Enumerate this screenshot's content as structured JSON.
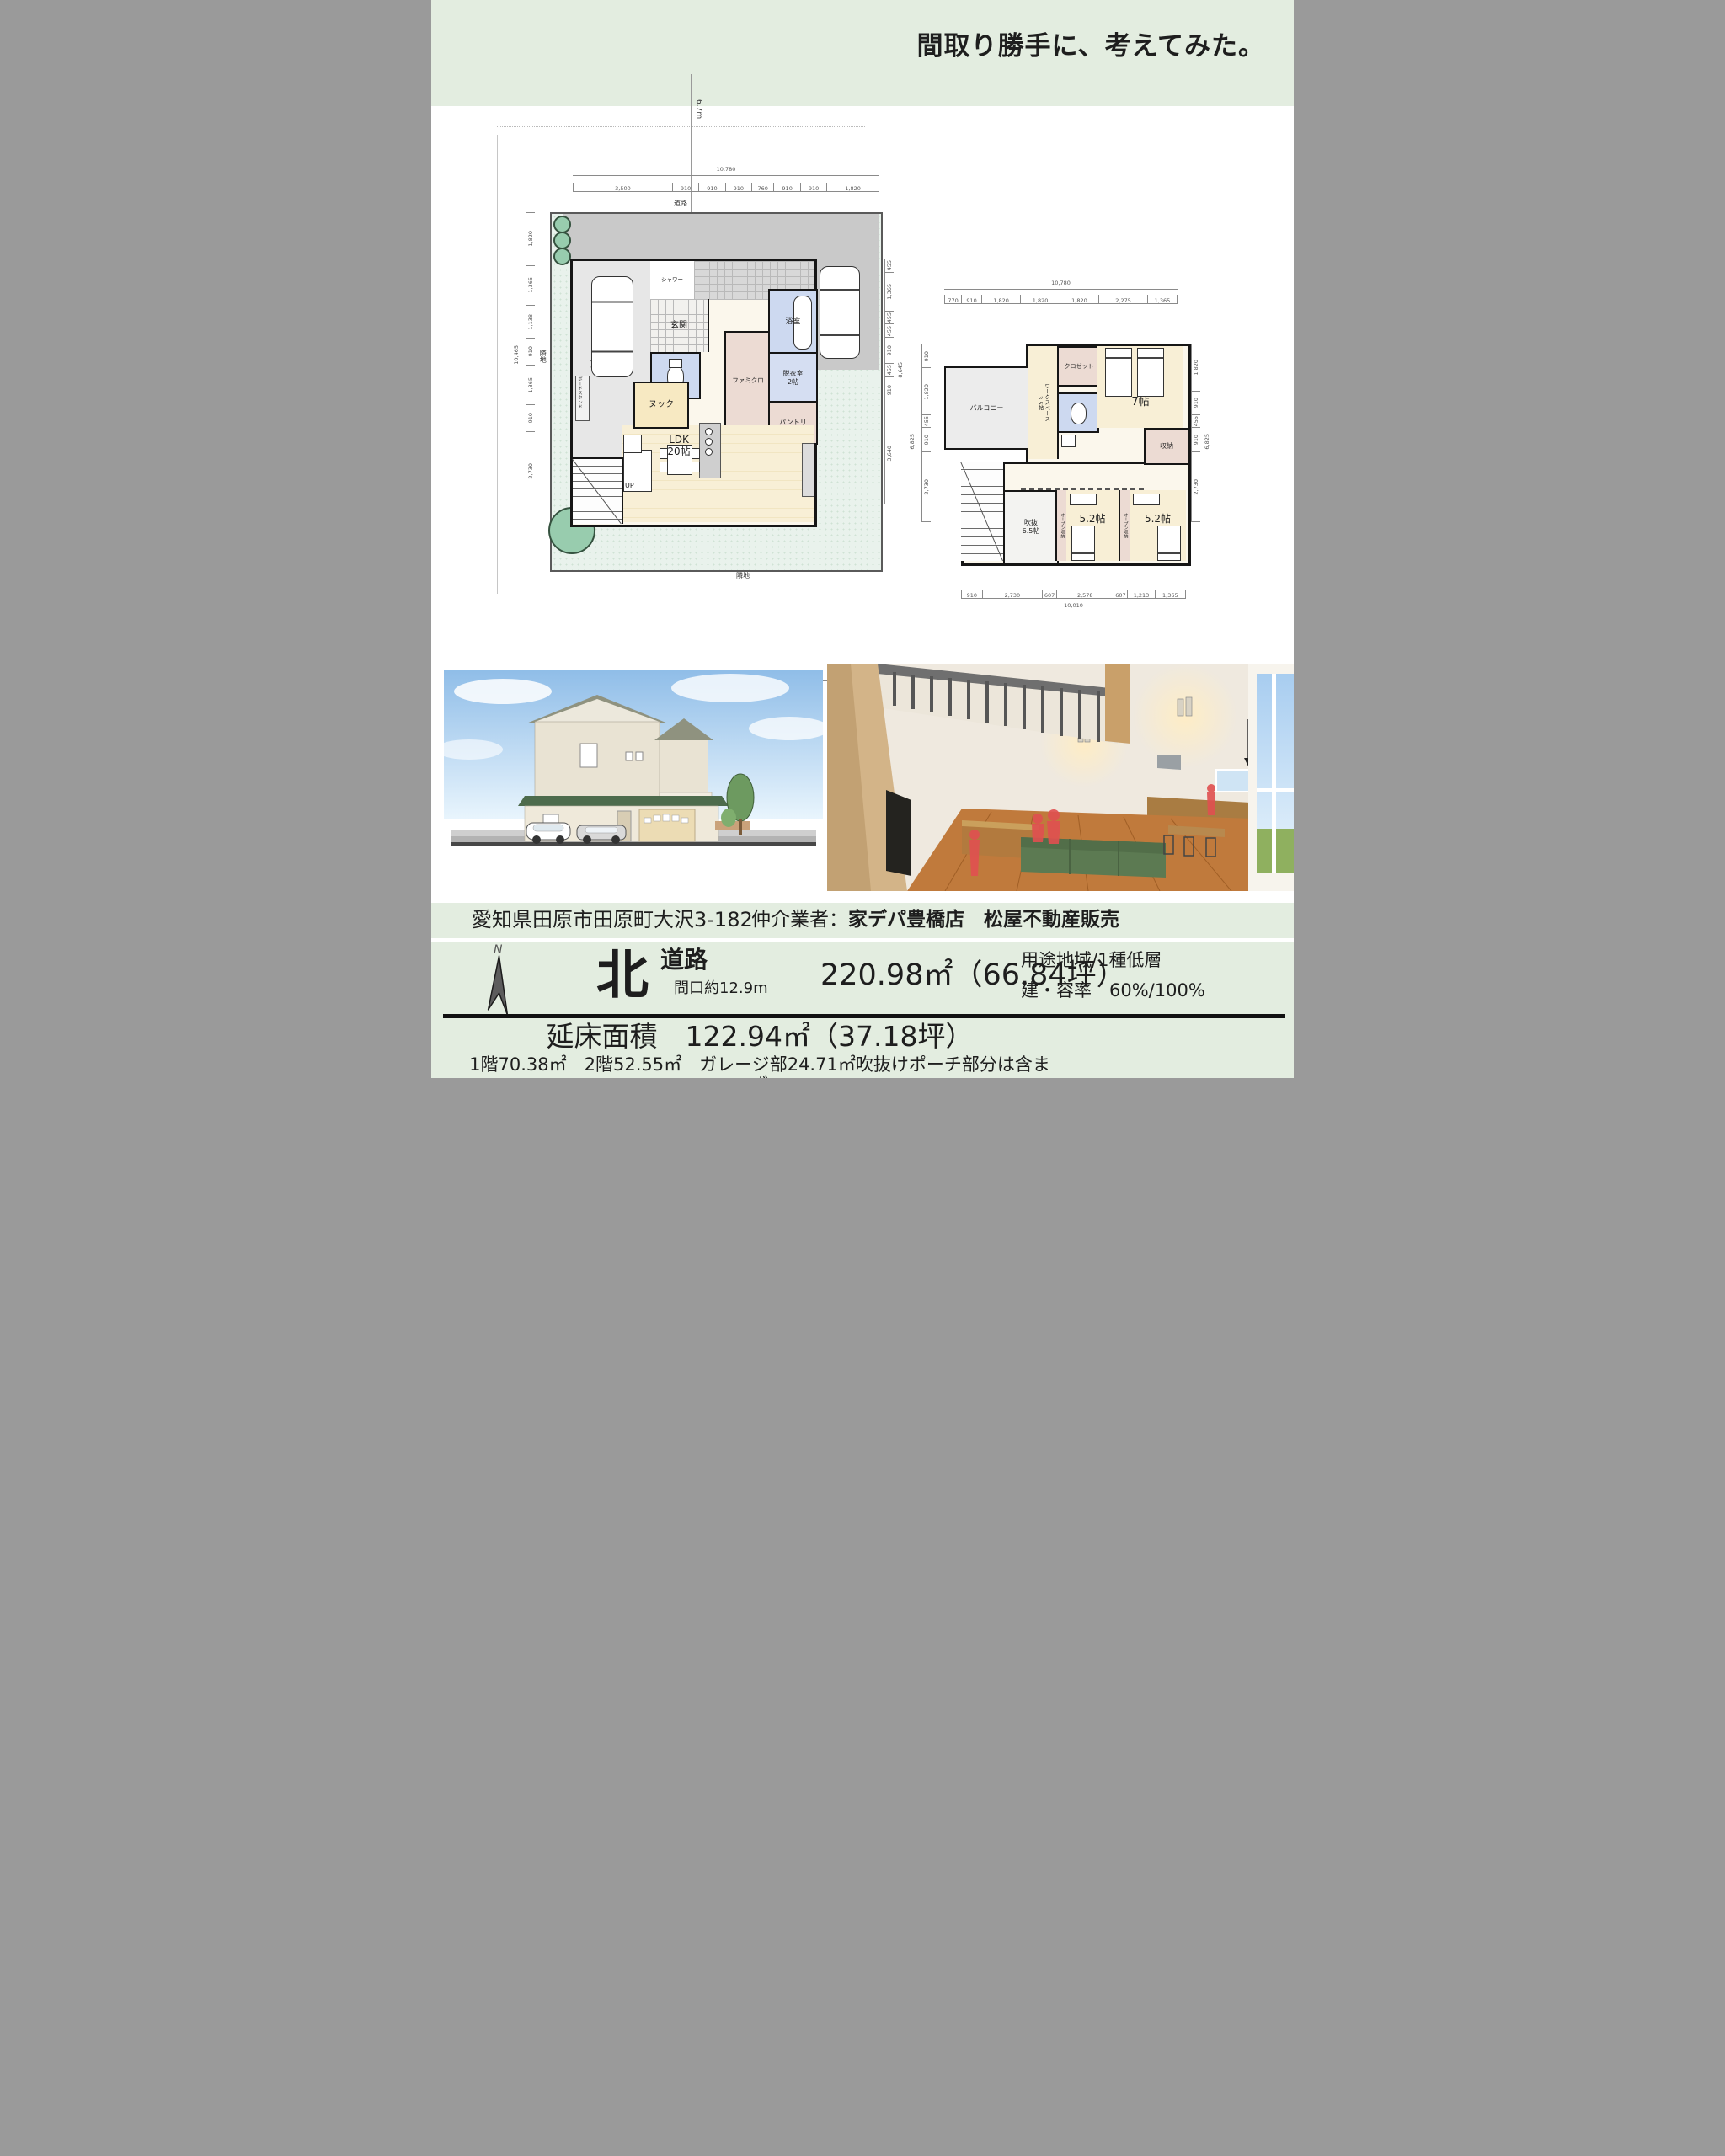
{
  "header": {
    "title": "間取り勝手に、考えてみた。"
  },
  "colors": {
    "band_green": "#e3ede0",
    "site_green": "#e9f2ec",
    "driveway_gray": "#c9c9c9",
    "room_cream": "#f8efd6",
    "wet_blue": "#cdd9f0",
    "closet_pink": "#ecdbd3",
    "wall_black": "#161616",
    "roof_green": "#4d6b4c",
    "tree_green": "#98ccae",
    "sofa_green": "#5c7a52",
    "silhouette_red": "#e05050"
  },
  "plan1": {
    "road": {
      "width_label": "6.7m",
      "road_label": "道路"
    },
    "site_labels": {
      "left": "隣地",
      "right": "隣地",
      "bottom": "隣地"
    },
    "rooms": {
      "garage": "ガレージ",
      "board_stand": "ボードスタンド",
      "shower": "シャワー",
      "entrance": "玄関",
      "famiclo": "ファミクロ",
      "bath": "浴室",
      "dressing": "脱衣室",
      "dressing_size": "2帖",
      "nook": "ヌック",
      "pantry": "パントリ",
      "ldk": "LDK",
      "ldk_size": "20帖",
      "up": "UP"
    },
    "dims": {
      "top": {
        "total": "10,780",
        "values": [
          3500,
          910,
          910,
          910,
          760,
          910,
          910,
          1820
        ],
        "labels": [
          "3,500",
          "910",
          "910",
          "910",
          "760",
          "910",
          "910",
          "1,820"
        ]
      },
      "bottom": {
        "total": "10,780",
        "values": [
          770,
          910,
          1820,
          910,
          1820,
          1670,
          455,
          2275
        ],
        "labels": [
          "770",
          "910",
          "1,820",
          "910",
          "1,820",
          "1,670",
          "455",
          "2,275"
        ]
      },
      "left": {
        "total": "10,465",
        "values": [
          1820,
          1365,
          1138,
          910,
          1365,
          910,
          2730
        ],
        "labels": [
          "1,820",
          "1,365",
          "1,138",
          "910",
          "1,365",
          "910",
          "2,730"
        ]
      },
      "right": {
        "total": "8,645",
        "values": [
          455,
          1365,
          455,
          455,
          910,
          455,
          910,
          3640
        ],
        "labels": [
          "455",
          "1,365",
          "455",
          "455",
          "910",
          "455",
          "910",
          "3,640"
        ]
      }
    }
  },
  "plan2": {
    "rooms": {
      "balcony": "バルコニー",
      "workspace": "ワークスペース\n3.5帖",
      "closet": "クロゼット",
      "bed7": "7帖",
      "dn": "DN",
      "storage": "収納",
      "void": "吹抜\n6.5帖",
      "open_storage": "オープン収納",
      "bed52": "5.2帖"
    },
    "dims": {
      "top": {
        "total": "10,780",
        "values": [
          770,
          910,
          1820,
          1820,
          1820,
          2275,
          1365
        ],
        "labels": [
          "770",
          "910",
          "1,820",
          "1,820",
          "1,820",
          "2,275",
          "1,365"
        ]
      },
      "bottom": {
        "total": "10,010",
        "values": [
          910,
          2730,
          607,
          2578,
          607,
          1213,
          1365
        ],
        "labels": [
          "910",
          "2,730",
          "607",
          "2,578",
          "607",
          "1,213",
          "1,365"
        ]
      },
      "left": {
        "total": "6,825",
        "values": [
          910,
          1820,
          455,
          910,
          2730
        ],
        "labels": [
          "910",
          "1,820",
          "455",
          "910",
          "2,730"
        ]
      },
      "right": {
        "total": "6,825",
        "values": [
          1820,
          910,
          455,
          910,
          2730
        ],
        "labels": [
          "1,820",
          "910",
          "455",
          "910",
          "2,730"
        ]
      }
    }
  },
  "address_bar": {
    "address": "愛知県田原市田原町大沢3-182",
    "broker_label": "仲介業者：",
    "broker_names": "家デパ豊橋店　松屋不動産販売"
  },
  "info": {
    "compass_n": "N",
    "direction": "北",
    "road": "道路",
    "frontage": "間口約12.9m",
    "land_area": "220.98㎡（66.84坪）",
    "zoning": "用途地域/1種低層",
    "coverage": "建・容率　60%/100%"
  },
  "floor_area": {
    "label": "延床面積",
    "value": "122.94㎡（37.18坪）",
    "breakdown": "1階70.38㎡　2階52.55㎡　ガレージ部24.71㎡吹抜けポーチ部分は含まず"
  }
}
